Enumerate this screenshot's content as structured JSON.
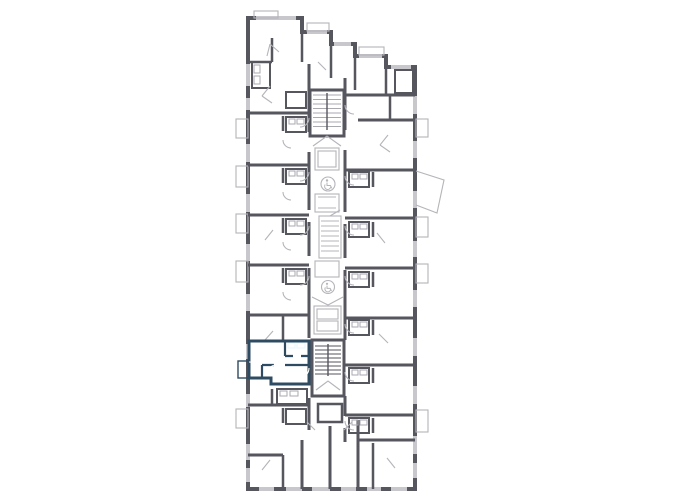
{
  "meta": {
    "view": "residential-building-floor-plan",
    "description": "Vertical multi-unit residential floor plan with central stair and elevator core; one apartment highlighted",
    "visible_text": []
  },
  "floorplan": {
    "colors": {
      "background": "#FFFFFF",
      "wall": "#56565E",
      "window": "#C7C7CC",
      "thin_outline": "#B4B4BA",
      "light_detail": "#A9A9B0",
      "highlight_fill": "#55C6F1",
      "highlight_wall": "#2F4B61"
    },
    "selected_unit": {
      "label": "Selected apartment",
      "side": "left",
      "vertical_position": "lower-middle",
      "rooms": [
        "living-room",
        "bathroom",
        "hallway",
        "balcony"
      ],
      "fill": "#55C6F1"
    },
    "core": {
      "stairwells": 2,
      "elevator_banks": 2,
      "elevator_icon": "wheelchair-accessible-elevator-icon",
      "corridor": "central-vertical"
    },
    "features": {
      "balconies_left": 5,
      "balconies_right": 5,
      "angled_balcony_right": 1,
      "staggered_top_edge_steps": 5
    }
  }
}
